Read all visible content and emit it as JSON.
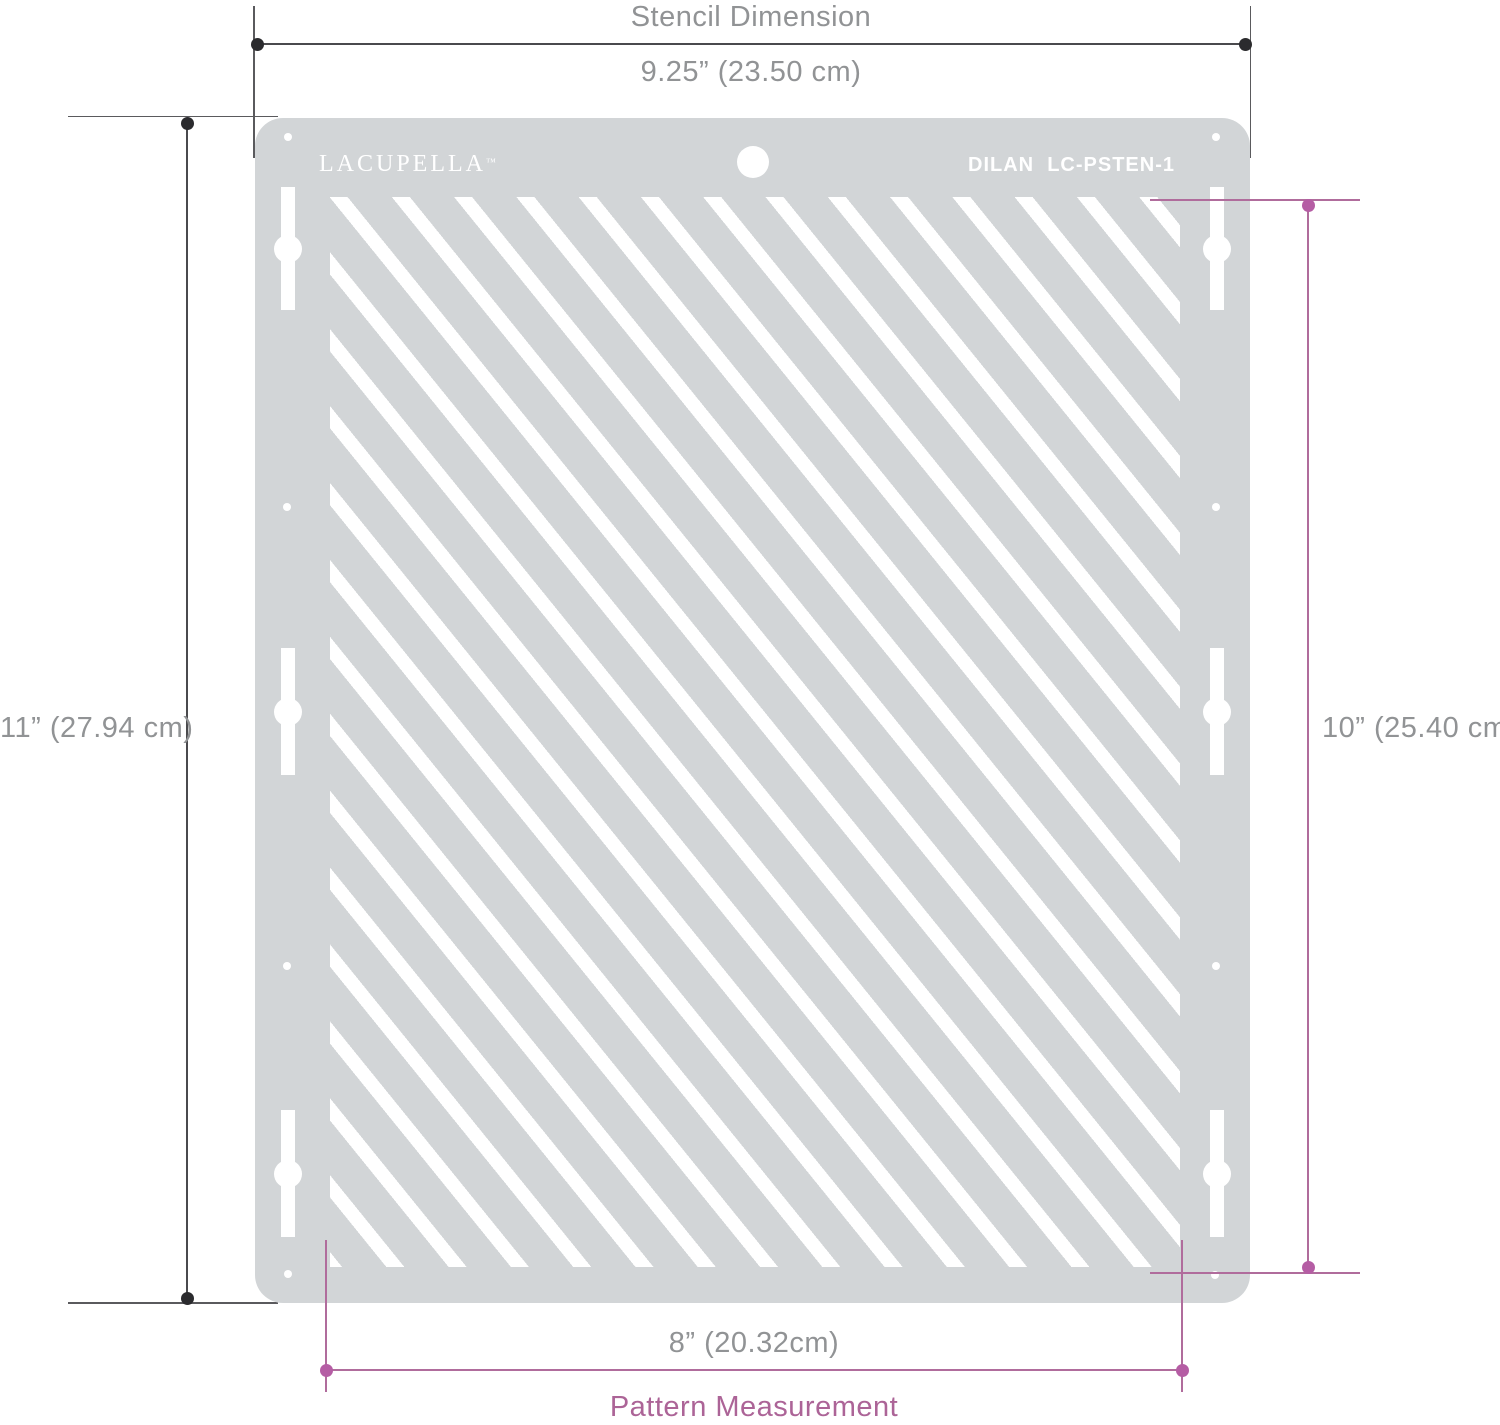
{
  "title": "Stencil Dimension",
  "footer": "Pattern Measurement",
  "stencil": {
    "brand": "LACUPELLA",
    "trademark": "™",
    "model": "DILAN  LC-PSTEN-1"
  },
  "measurements": {
    "stencil_width": "9.25” (23.50 cm)",
    "stencil_height": "11” (27.94 cm)",
    "pattern_height": "10” (25.40 cm)",
    "pattern_width": "8” (20.32cm)"
  },
  "colors": {
    "plate": "#d2d5d7",
    "stripe": "#ffffff",
    "dark-line": "#4a4a4d",
    "dark-dot": "#2b2b2e",
    "gray-text": "#919395",
    "pink-line": "#b06c9c",
    "pink-dot": "#b55da4",
    "pink-text": "#ac6497"
  }
}
